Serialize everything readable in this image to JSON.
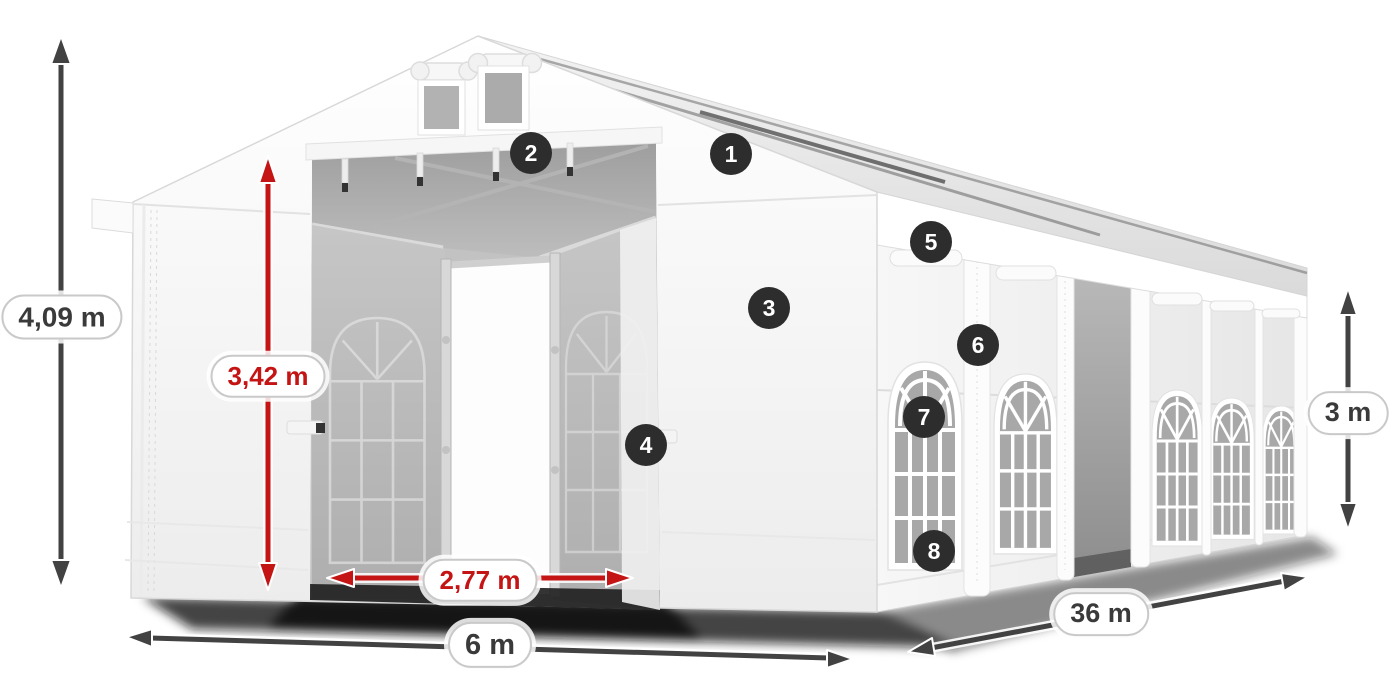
{
  "dimensions": {
    "total_height": {
      "label": "4,09 m",
      "color": "#3a3a3a",
      "arrow": "dark",
      "orientation": "vertical"
    },
    "entrance_height": {
      "label": "3,42 m",
      "color": "#c41414",
      "arrow": "red",
      "orientation": "vertical"
    },
    "entrance_width": {
      "label": "2,77 m",
      "color": "#c41414",
      "arrow": "red",
      "orientation": "horizontal"
    },
    "width": {
      "label": "6 m",
      "color": "#3a3a3a",
      "arrow": "dark",
      "orientation": "horizontal"
    },
    "length": {
      "label": "36 m",
      "color": "#3a3a3a",
      "arrow": "dark",
      "orientation": "diagonal"
    },
    "side_height": {
      "label": "3 m",
      "color": "#3a3a3a",
      "arrow": "dark",
      "orientation": "vertical"
    }
  },
  "callouts": [
    {
      "number": "1"
    },
    {
      "number": "2"
    },
    {
      "number": "3"
    },
    {
      "number": "4"
    },
    {
      "number": "5"
    },
    {
      "number": "6"
    },
    {
      "number": "7"
    },
    {
      "number": "8"
    }
  ],
  "colors": {
    "background": "#ffffff",
    "arrow_dark": "#424242",
    "arrow_red": "#c41414",
    "badge_background": "#2d2d2d",
    "badge_text": "#ffffff",
    "pill_background": "#ffffff",
    "pill_border": "#c9c9c9",
    "tent_white": "#f7f7f7",
    "window_pane": "#a8a8a8"
  }
}
